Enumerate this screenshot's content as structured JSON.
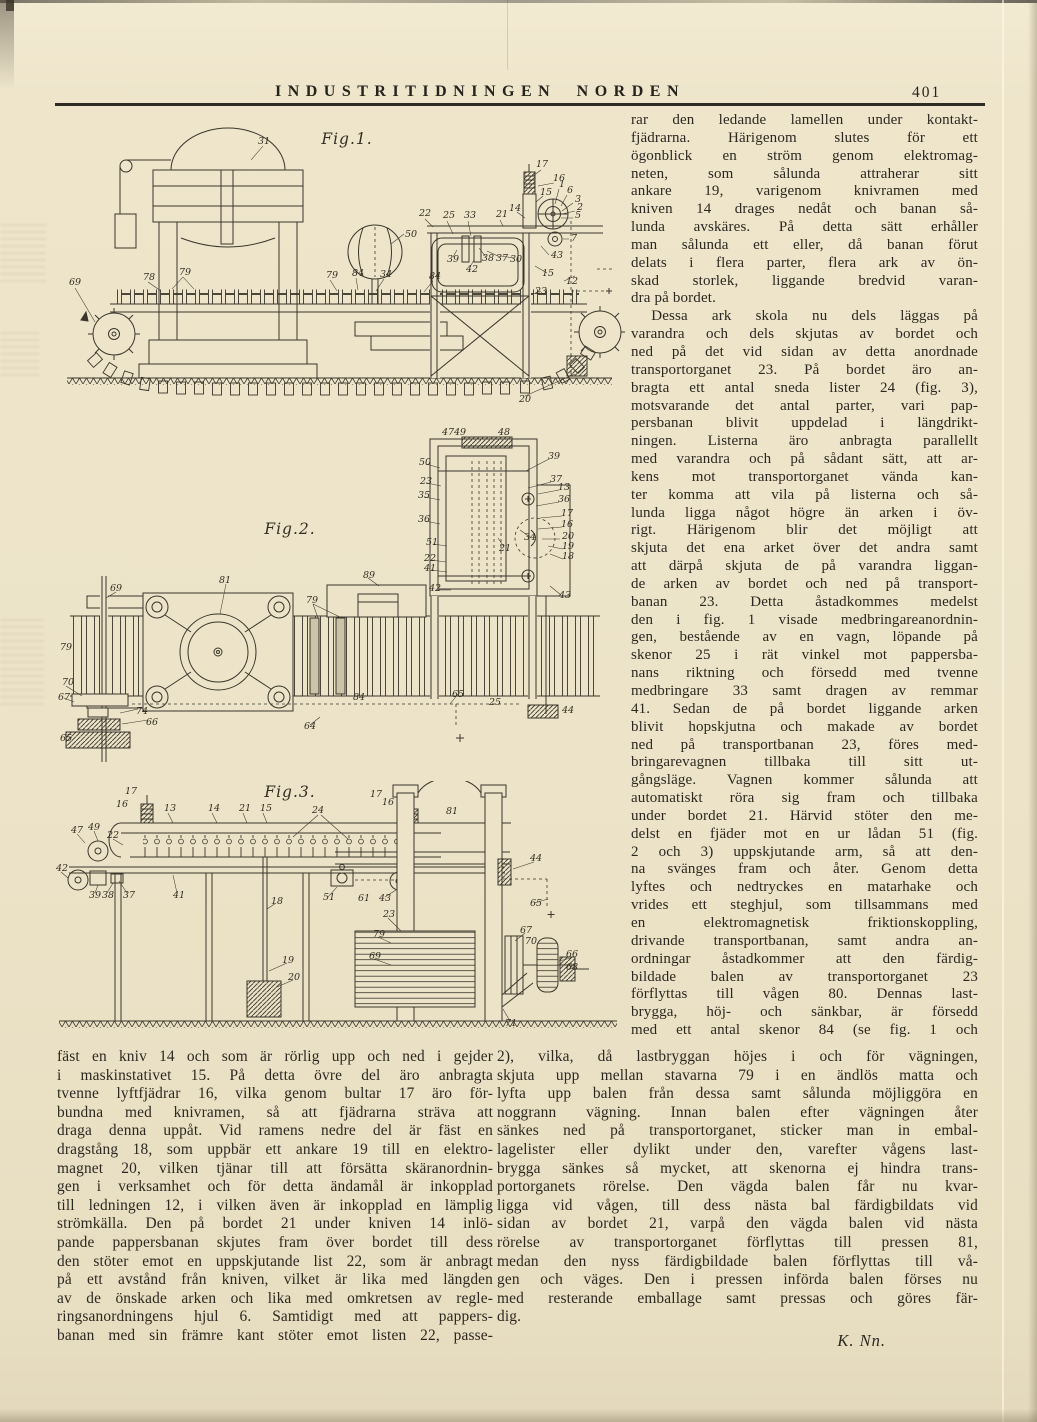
{
  "page": {
    "paper_color": "#ece3c8",
    "ink_color": "#3a362b",
    "text_color": "#2c2820"
  },
  "header": {
    "title": "INDUSTRITIDNINGEN NORDEN",
    "page_number": "401"
  },
  "figures": {
    "fig1": {
      "caption": "Fig.1.",
      "labels": [
        "31",
        "50",
        "69",
        "78",
        "79",
        "79",
        "84",
        "34",
        "84",
        "22",
        "25",
        "33",
        "21",
        "17",
        "16",
        "15",
        "14",
        "1",
        "6",
        "3",
        "2",
        "5",
        "7",
        "39",
        "42",
        "38",
        "37",
        "30",
        "43",
        "12",
        "15",
        "23",
        "20"
      ]
    },
    "fig2": {
      "caption": "Fig.2.",
      "labels": [
        "47",
        "49",
        "48",
        "50",
        "23",
        "35",
        "36",
        "51",
        "22",
        "41",
        "42",
        "39",
        "37",
        "13",
        "36",
        "17",
        "16",
        "20",
        "19",
        "18",
        "21",
        "34",
        "43",
        "44",
        "25",
        "65",
        "64",
        "81",
        "89",
        "79",
        "79",
        "84",
        "69",
        "70",
        "67",
        "74",
        "66",
        "65"
      ]
    },
    "fig3": {
      "caption": "Fig.3.",
      "labels": [
        "17",
        "16",
        "13",
        "14",
        "21",
        "15",
        "24",
        "17",
        "16",
        "22",
        "49",
        "47",
        "42",
        "39",
        "38",
        "37",
        "41",
        "18",
        "51",
        "61",
        "43",
        "81",
        "44",
        "65",
        "23",
        "79",
        "69",
        "19",
        "20",
        "67",
        "70",
        "66",
        "68",
        "71"
      ]
    }
  },
  "columns": {
    "right": {
      "lines": [
        "rar den ledande lamellen under kontakt-",
        "fjädrarna.  Härigenom  slutes  för  ett",
        "ögonblick en ström genom elektromag-",
        "neten,  som  sålunda  attraherar  sitt",
        "ankare 19, varigenom knivramen med",
        "kniven 14 drages nedåt och banan så-",
        "lunda avskäres.  På detta sätt erhåller",
        "man sålunda ett eller, då banan förut",
        "delats i flera parter, flera ark av ön-",
        "skad storlek, liggande bredvid varan-",
        {
          "t": "dra på bordet.",
          "c": "end"
        },
        {
          "t": "Dessa ark skola nu dels läggas på",
          "c": "ind"
        },
        "varandra och dels skjutas av bordet och",
        "ned på det vid sidan av detta anordnade",
        "transportorganet 23.  På bordet äro an-",
        "bragta ett antal sneda lister 24 (fig. 3),",
        "motsvarande det antal parter, vari pap-",
        "persbanan blivit uppdelad i längdrikt-",
        "ningen.  Listerna äro anbragta parallellt",
        "med varandra och på sådant sätt, att ar-",
        "kens mot transportorganet vända kan-",
        "ter komma att vila på listerna och så-",
        "lunda ligga något högre än arken i öv-",
        "rigt.  Härigenom blir det möjligt att",
        "skjuta det ena arket över det andra samt",
        "att därpå skjuta de på varandra liggan-",
        "de arken av bordet och ned på transport-",
        "banan 23.  Detta åstadkommes medelst",
        "den i fig. 1 visade medbringareanordnin-",
        "gen, bestående av en vagn, löpande på",
        "skenor 25 i rät vinkel mot pappersba-",
        "nans riktning och försedd med tvenne",
        "medbringare 33 samt dragen av remmar",
        "41.  Sedan de på bordet liggande arken",
        "blivit hopskjutna och makade av bordet",
        "ned på transportbanan 23, föres med-",
        "bringarevagnen  tillbaka  till  sitt  ut-",
        "gångsläge.  Vagnen kommer sålunda att",
        "automatiskt röra sig fram och tillbaka",
        "under bordet 21.  Härvid stöter den me-",
        "delst en fjäder mot en ur lådan 51 (fig.",
        "2 och 3) uppskjutande arm, så att den-",
        "na svänges fram och åter.  Genom detta",
        "lyftes och nedtryckes en matarhake och",
        "vrides ett steghjul, som tillsammans med",
        "en  elektromagnetisk  friktionskoppling,",
        "drivande transportbanan, samt andra an-",
        "ordningar åstadkommer att den färdig-",
        "bildade balen av transportorganet 23",
        "förflyttas till vågen 80.  Dennas last-",
        "brygga,  höj-  och  sänkbar,  är  försedd",
        "med ett antal skenor 84 (se fig. 1 och"
      ]
    },
    "bottom_left": {
      "lines": [
        "fäst en kniv 14 och som är rörlig upp och ned i gejder",
        "i maskinstativet 15.  På detta övre del äro anbragta",
        "tvenne lyftfjädrar 16, vilka genom bultar 17 äro för-",
        "bundna med knivramen, så att fjädrarna sträva att",
        "draga denna uppåt.  Vid ramens nedre del är fäst en",
        "dragstång 18, som uppbär ett ankare 19 till en elektro-",
        "magnet 20, vilken tjänar till att försätta skäranordnin-",
        "gen i verksamhet och för detta ändamål är inkopplad",
        "till ledningen 12, i vilken även är inkopplad en lämplig",
        "strömkälla.  Den på bordet 21 under kniven 14 inlö-",
        "pande pappersbanan skjutes fram över bordet till dess",
        "den stöter emot en uppskjutande list 22, som är anbragt",
        "på ett avstånd från kniven, vilket är lika med längden",
        "av de önskade arken och lika med omkretsen av regle-",
        "ringsanordningens hjul 6.  Samtidigt med att pappers-",
        "banan med sin främre kant stöter emot listen 22, passe-"
      ]
    },
    "bottom_right": {
      "lines": [
        "2), vilka, då lastbryggan höjes i och för vägningen,",
        "skjuta upp mellan stavarna 79 i en ändlös matta och",
        "lyfta upp balen från dessa samt sålunda möjliggöra en",
        "noggrann vägning.  Innan balen efter vägningen åter",
        "sänkes ned på transportorganet, sticker man in embal-",
        "lagelister eller dylikt under den, varefter vågens last-",
        "brygga sänkes så mycket, att skenorna ej hindra trans-",
        "portorganets rörelse.  Den  vägda balen får nu kvar-",
        "ligga vid vågen, till dess nästa bal färdigbildats vid",
        "sidan av bordet 21, varpå den vägda balen vid nästa",
        "rörelse av transportorganet förflyttas till pressen 81,",
        "medan den nyss färdigbildade balen förflyttas till vå-",
        "gen och väges.  Den i pressen införda balen förses nu",
        "med resterande emballage samt pressas och göres fär-",
        {
          "t": "dig.",
          "c": "end"
        },
        {
          "t": "K. Nn.",
          "c": "sig"
        }
      ]
    }
  }
}
